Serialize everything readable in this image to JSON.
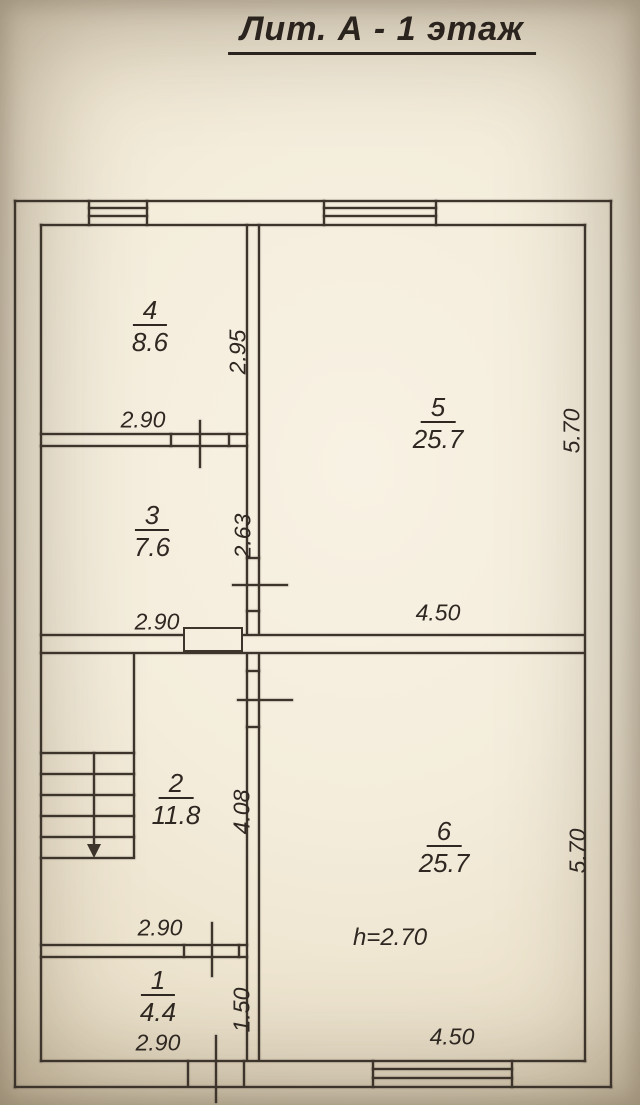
{
  "title": "Лит. А - 1 этаж",
  "rooms": {
    "r1": {
      "number": "1",
      "area": "4.4"
    },
    "r2": {
      "number": "2",
      "area": "11.8"
    },
    "r3": {
      "number": "3",
      "area": "7.6"
    },
    "r4": {
      "number": "4",
      "area": "8.6"
    },
    "r5": {
      "number": "5",
      "area": "25.7"
    },
    "r6": {
      "number": "6",
      "area": "25.7"
    }
  },
  "dimension_labels": {
    "room4_width": "2.90",
    "room4_depth": "2.95",
    "room3_width": "2.90",
    "room3_depth": "2.63",
    "room5_width": "4.50",
    "room5_depth": "5.70",
    "room2_width": "2.90",
    "room2_depth": "4.08",
    "room1_width": "2.90",
    "room1_depth": "1.50",
    "room6_width": "4.50",
    "room6_depth": "5.70",
    "ceiling_height": "h=2.70"
  },
  "colors": {
    "ink": "#3d342c",
    "text": "#2f2822",
    "paper_light": "#f8f2e4",
    "paper_dark": "#c0b092"
  }
}
